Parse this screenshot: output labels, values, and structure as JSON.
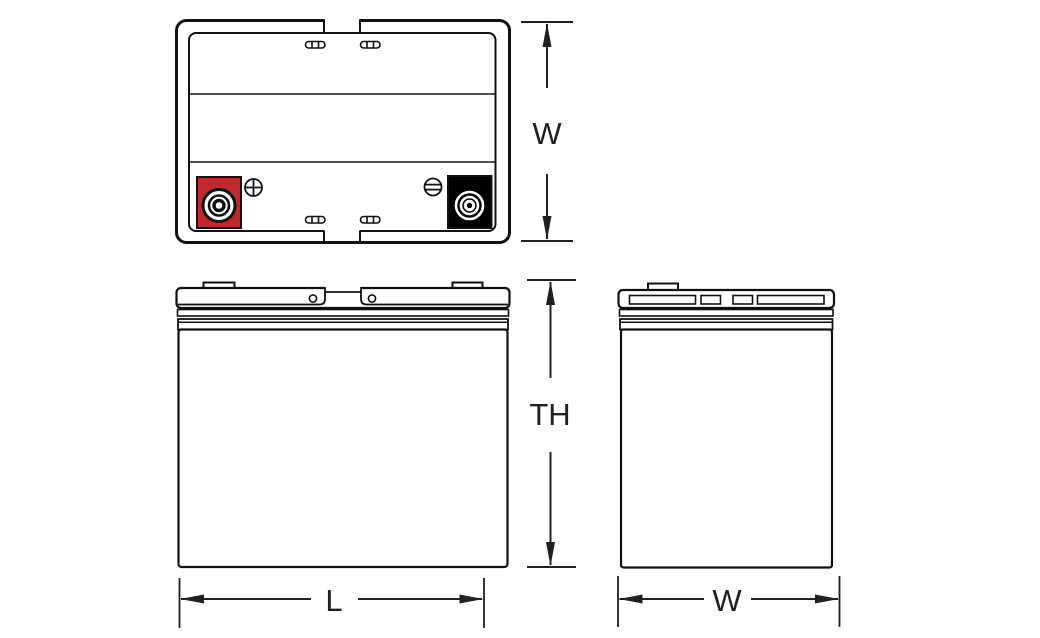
{
  "diagram": {
    "type": "battery-outline-drawing",
    "views": {
      "top_view": "battery top view with terminals",
      "front_view": "battery front view",
      "side_view": "battery side view"
    }
  },
  "labels": {
    "top_width": "W",
    "total_height": "TH",
    "length": "L",
    "side_width": "W"
  },
  "colors": {
    "positive_terminal": "#c1272d",
    "negative_terminal": "#000000",
    "line": "#111111",
    "background": "#ffffff"
  },
  "icons": {
    "positive_polarity": "circle-plus",
    "negative_polarity": "circle-minus"
  }
}
